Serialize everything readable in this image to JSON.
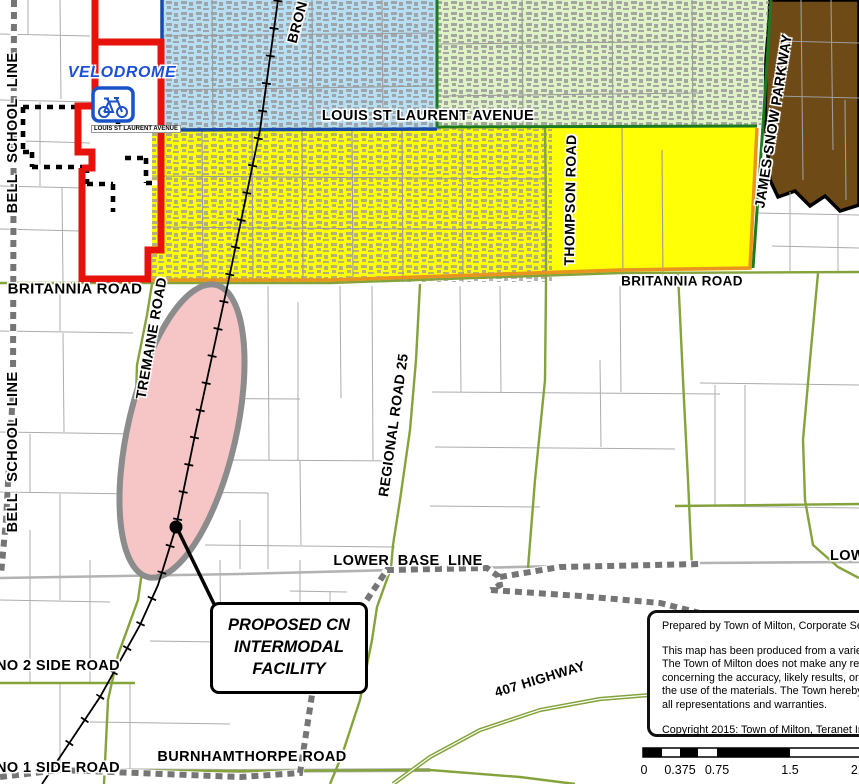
{
  "title": "Town of Milton map - Proposed CN Intermodal Facility",
  "map_labels": {
    "bell_school_line": "BELL SCHOOL LINE",
    "tremaine_road": "TREMAINE ROAD",
    "britannia_road": "BRITANNIA ROAD",
    "louis_st_laurent_avenue": "LOUIS ST LAURENT AVENUE",
    "regional_road_25": "REGIONAL ROAD 25",
    "thompson_road": "THOMPSON ROAD",
    "james_snow_parkway": "JAMES SNOW PARKWAY",
    "bronte_street_partial": "BRON",
    "lower_base_line": "LOWER BASE LINE",
    "no_2_side_road": "NO 2 SIDE ROAD",
    "no_1_side_road": "NO 1 SIDE ROAD",
    "burnhamthorpe_road": "BURNHAMTHORPE ROAD",
    "highway_407": "407 HIGHWAY",
    "velodrome": "VELODROME"
  },
  "callout": {
    "line1": "PROPOSED CN",
    "line2": "INTERMODAL",
    "line3": "FACILITY"
  },
  "disclaimer": {
    "prepared": "Prepared by Town of Milton, Corporate Ser",
    "body1": "This map has been produced from a variet",
    "body2": "The Town of Milton does not make any rep",
    "body3": "concerning the accuracy, likely results, or r",
    "body4": "the use of the materials. The Town hereby",
    "body5": "all representations and warranties.",
    "copyright": "Copyright 2015: Town of Milton, Teranet In"
  },
  "scale_bar": {
    "labels": [
      "0",
      "0.375",
      "0.75",
      "1.5",
      "2.25"
    ]
  },
  "icons": {
    "bicycle_icon": "velodrome cycling facility marker",
    "facility_dot": "proposed facility location point"
  },
  "colors": {
    "urban_residential_blue": "#b7dff3",
    "urban_green": "#dff2c6",
    "employment_yellow": "#ffff00",
    "industrial_brown": "#6e4a16",
    "facility_pink": "#f6c6c6",
    "boundary_red": "#e8120c",
    "boundary_orange": "#e8941e",
    "arterial_olive": "#84a33b",
    "avenue_dark_blue": "#1a4aa8",
    "parkway_dark_green": "#1e7a1f",
    "velodrome_blue": "#1c4fd8"
  }
}
